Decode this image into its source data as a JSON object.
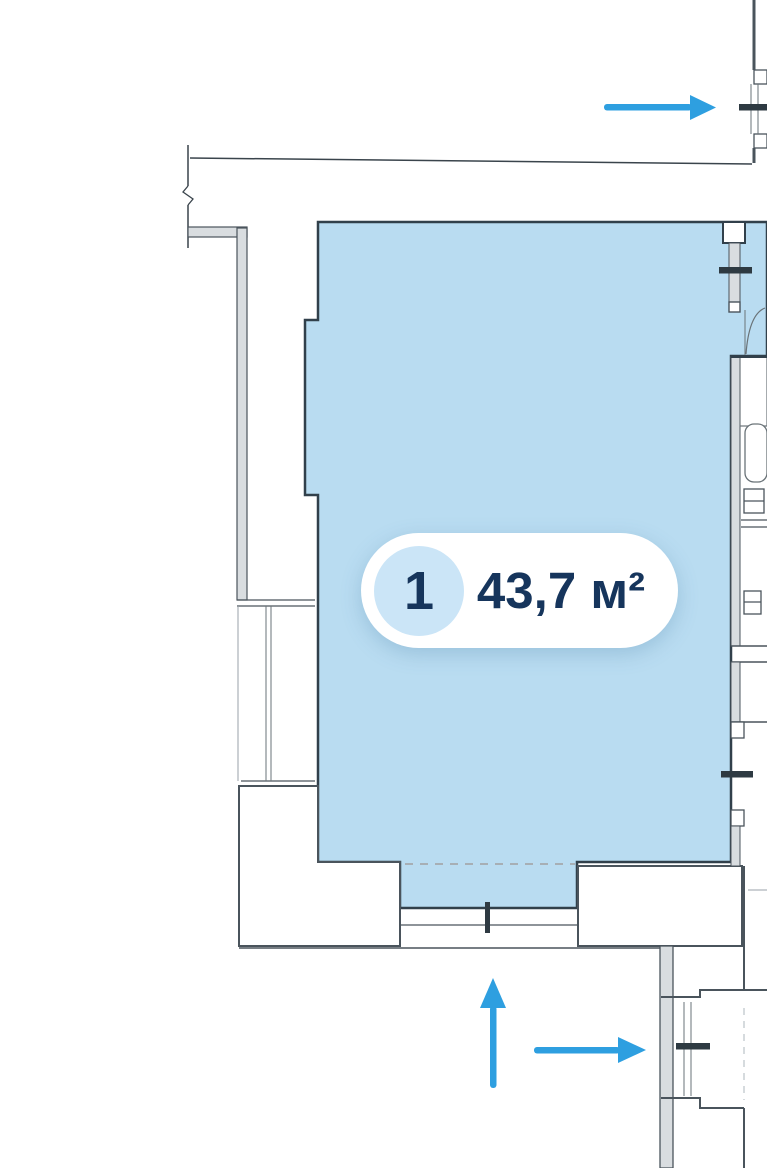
{
  "theme": {
    "canvas-bg": "#FFFFFF",
    "room-fill": "#B9DCF1",
    "room-stroke": "#31404B",
    "wall-stroke": "#4A545C",
    "wall-fill": "#D9DDE0",
    "thin-line": "#6A7378",
    "faint-line": "#9AA2A8",
    "dash-color": "#A7AFB5",
    "arrow-color": "#2E9FE0",
    "badge-bg": "#FFFFFF",
    "badge-text": "#16355C",
    "badge-circle-bg": "#CBE5F7"
  },
  "unit": {
    "number": "1",
    "area_label": "43,7 м²"
  },
  "annotations": {
    "arrows": [
      {
        "id": "top-right",
        "direction": "right"
      },
      {
        "id": "bottom-up",
        "direction": "up"
      },
      {
        "id": "bottom-right",
        "direction": "right"
      }
    ]
  }
}
